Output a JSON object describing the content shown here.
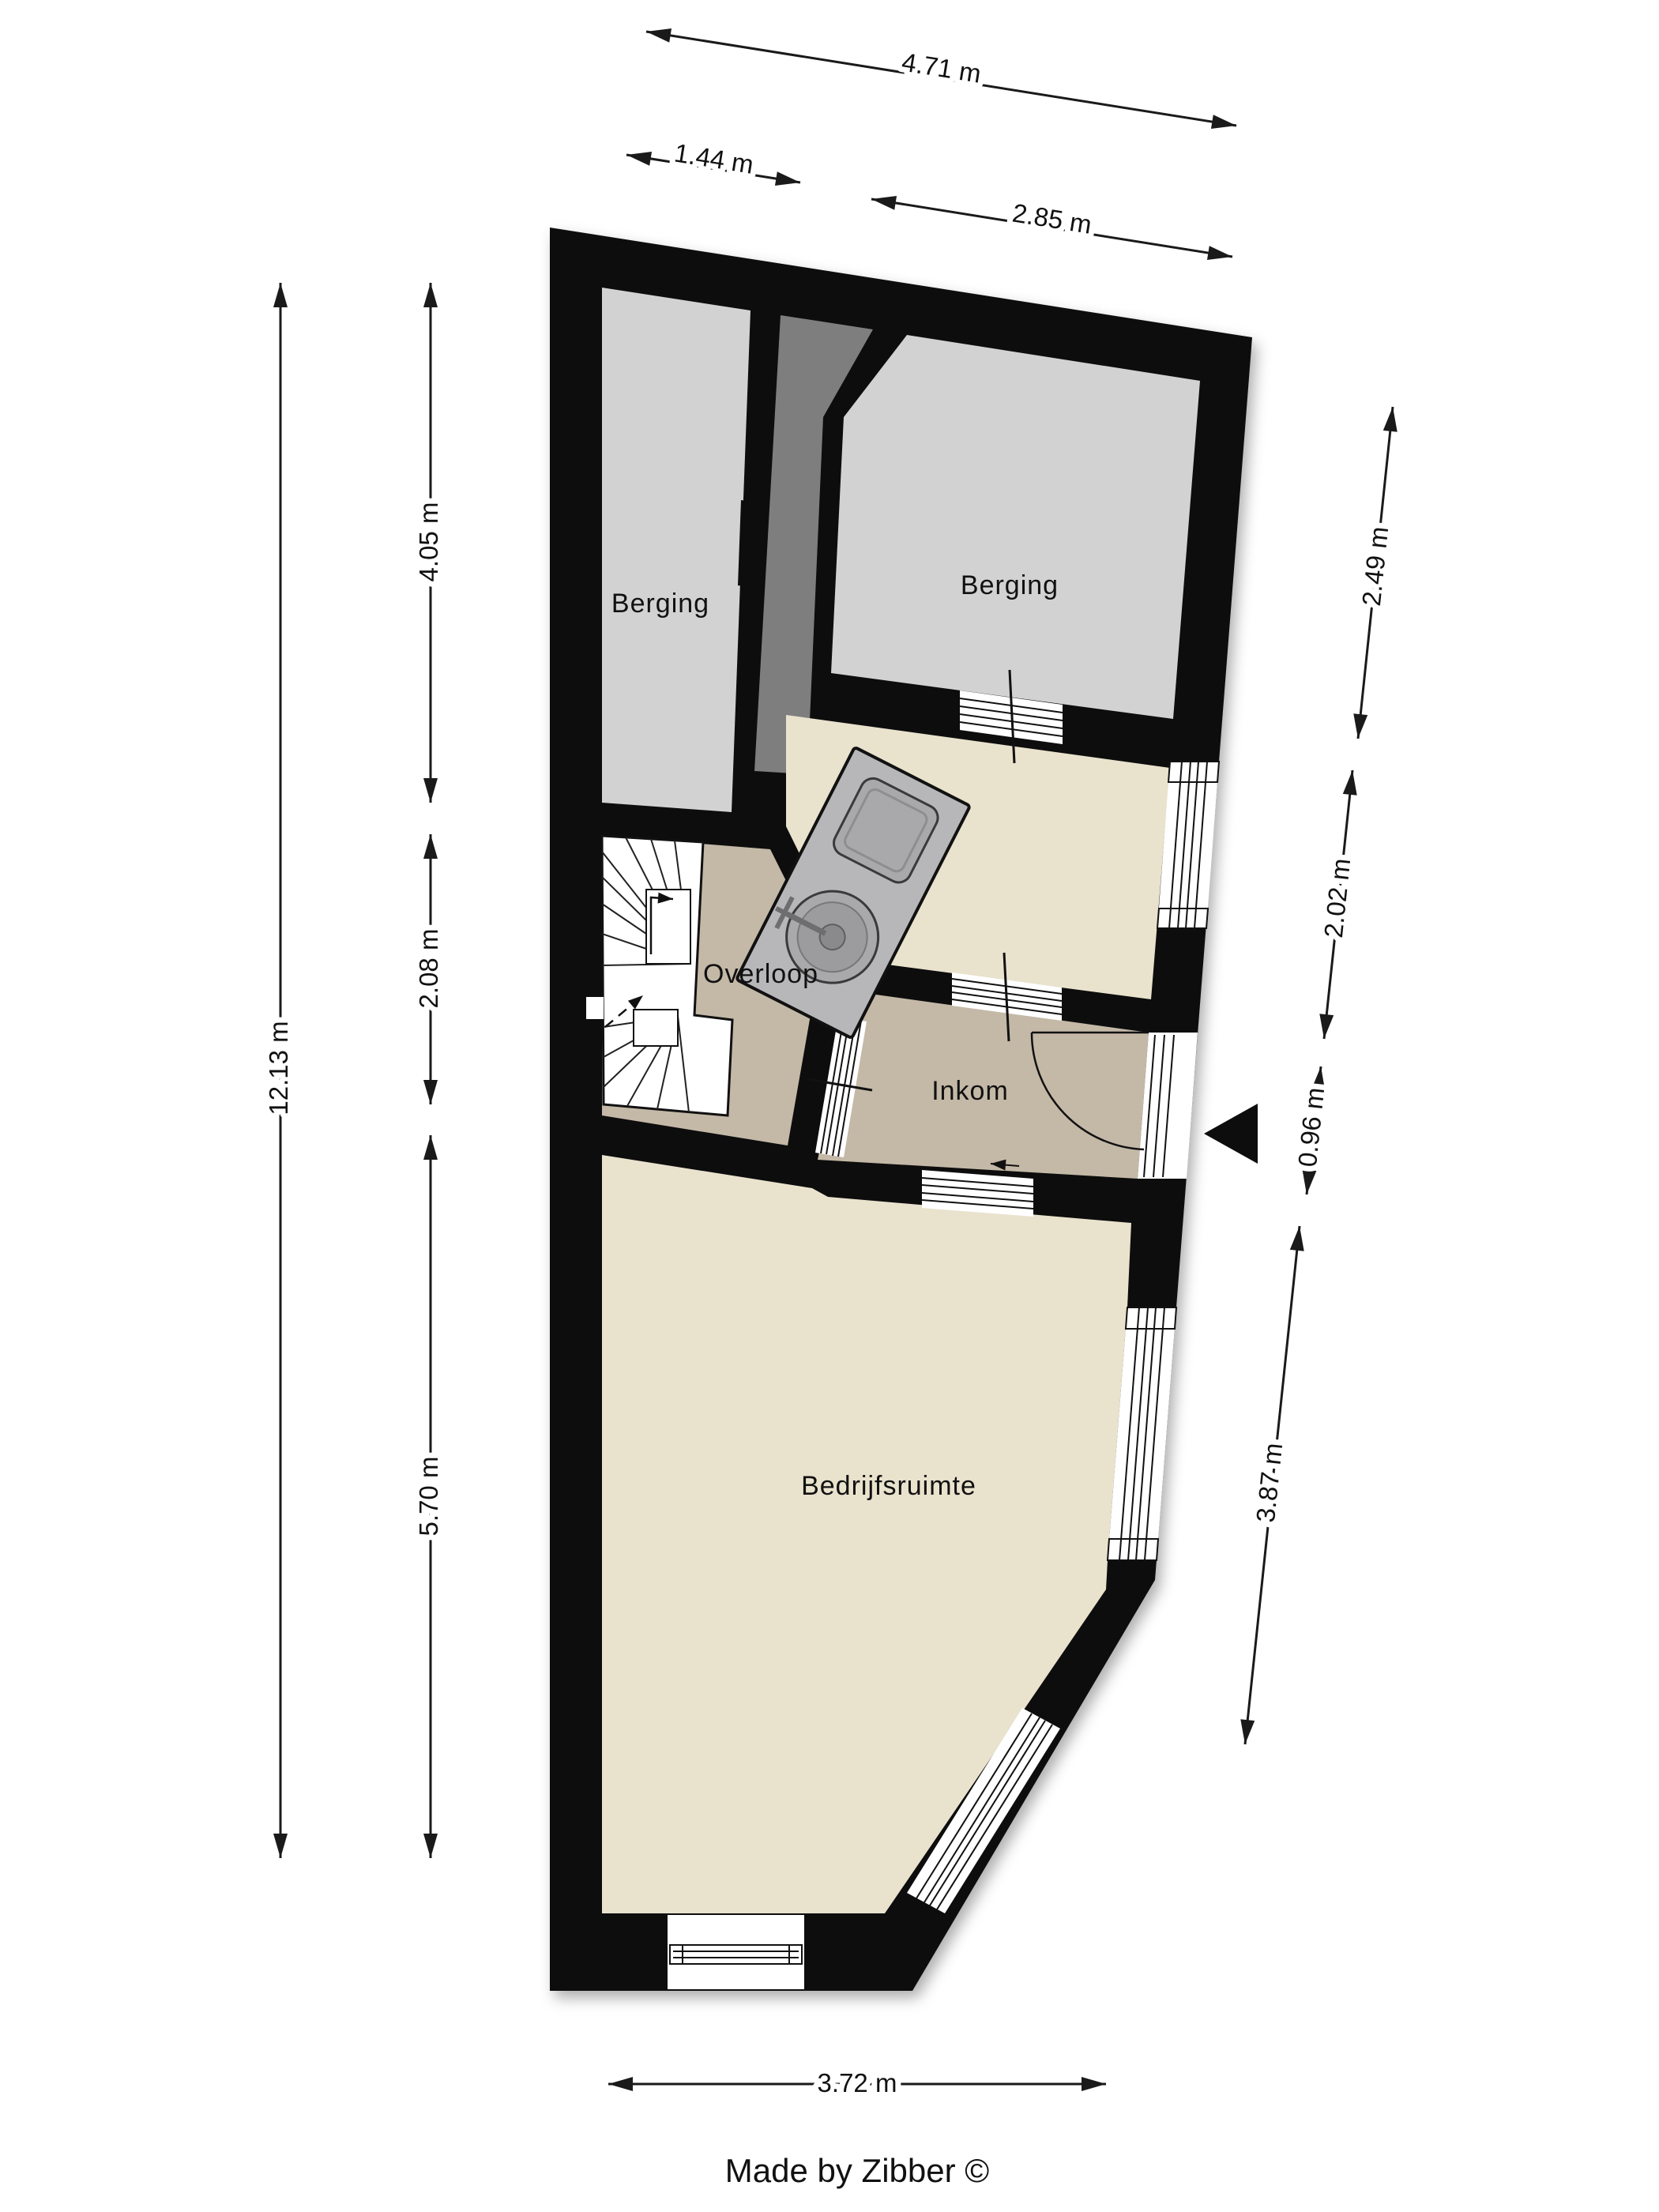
{
  "branding": {
    "credit": "Made by Zibber ©"
  },
  "rooms": {
    "berging_left": "Berging",
    "berging_right": "Berging",
    "overloop": "Overloop",
    "inkom": "Inkom",
    "bedrijfsruimte": "Bedrijfsruimte"
  },
  "dimensions": {
    "top_overall": "4.71 m",
    "top_left": "1.44 m",
    "top_right": "2.85 m",
    "left_overall": "12.13 m",
    "left_upper": "4.05 m",
    "left_middle": "2.08 m",
    "left_lower": "5.70 m",
    "right_upper": "2.49 m",
    "right_middle": "2.02 m",
    "right_small": "0.96 m",
    "right_lower": "3.87 m",
    "bottom": "3.72 m"
  },
  "colors": {
    "background": "#ffffff",
    "wall": "#0d0d0d",
    "room_gray": "#d2d2d2",
    "void_gray": "#7e7e7e",
    "room_cream": "#e9e2cd",
    "room_taupe": "#c4b8a7",
    "stair_white": "#ffffff",
    "counter": "#b7b7b9",
    "basin": "#a9a9ab",
    "line": "#1a1a1a"
  }
}
